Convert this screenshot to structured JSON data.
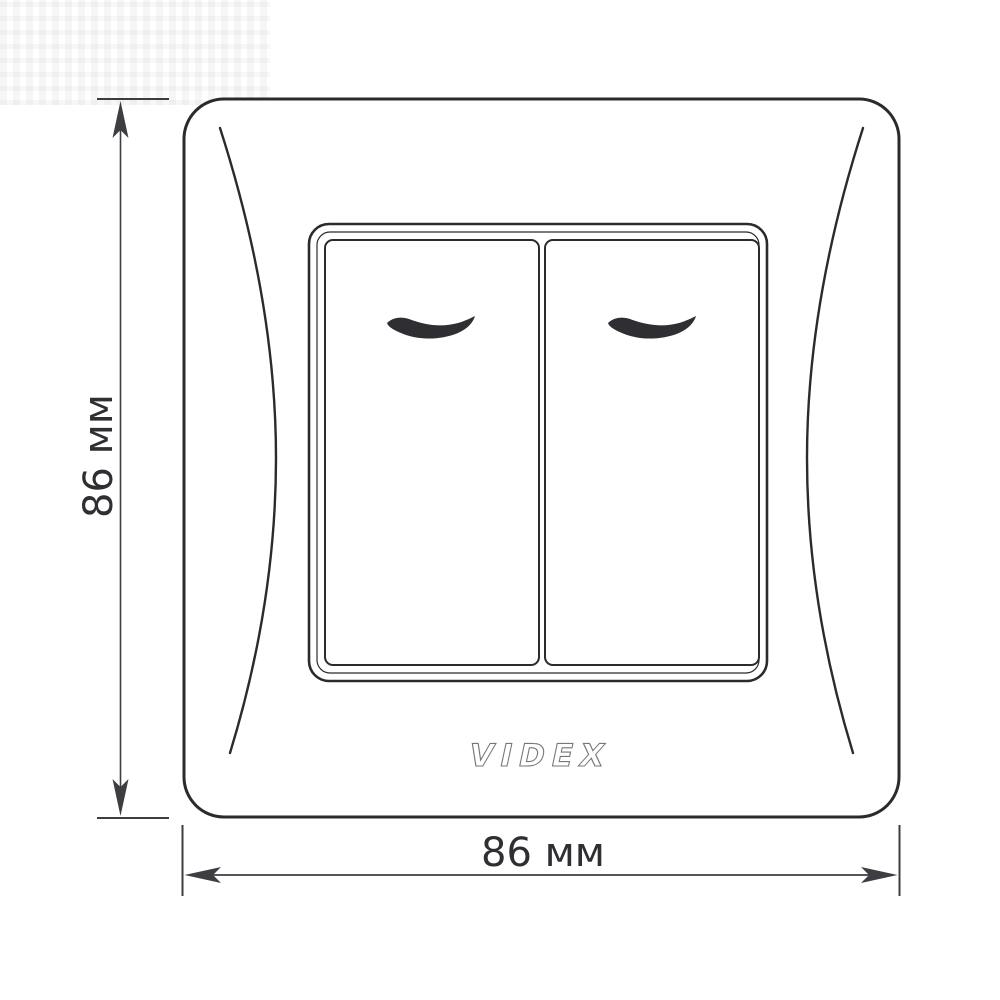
{
  "drawing": {
    "title_hint": "",
    "brand_logo": "VIDEX",
    "dimensions": {
      "height_label": "86 мм",
      "width_label": "86 мм"
    }
  },
  "colors": {
    "background": "#ffffff",
    "outline": "#2b2b2e",
    "crescent_fill": "#2e2e33",
    "dimension_lines": "#3d3d42",
    "label_text": "#2f2f33",
    "logo_outline": "#77777b"
  },
  "icons": {
    "rocker_mark": "crescent-swoosh",
    "arrowheads": "slender-barbed-arrow"
  }
}
